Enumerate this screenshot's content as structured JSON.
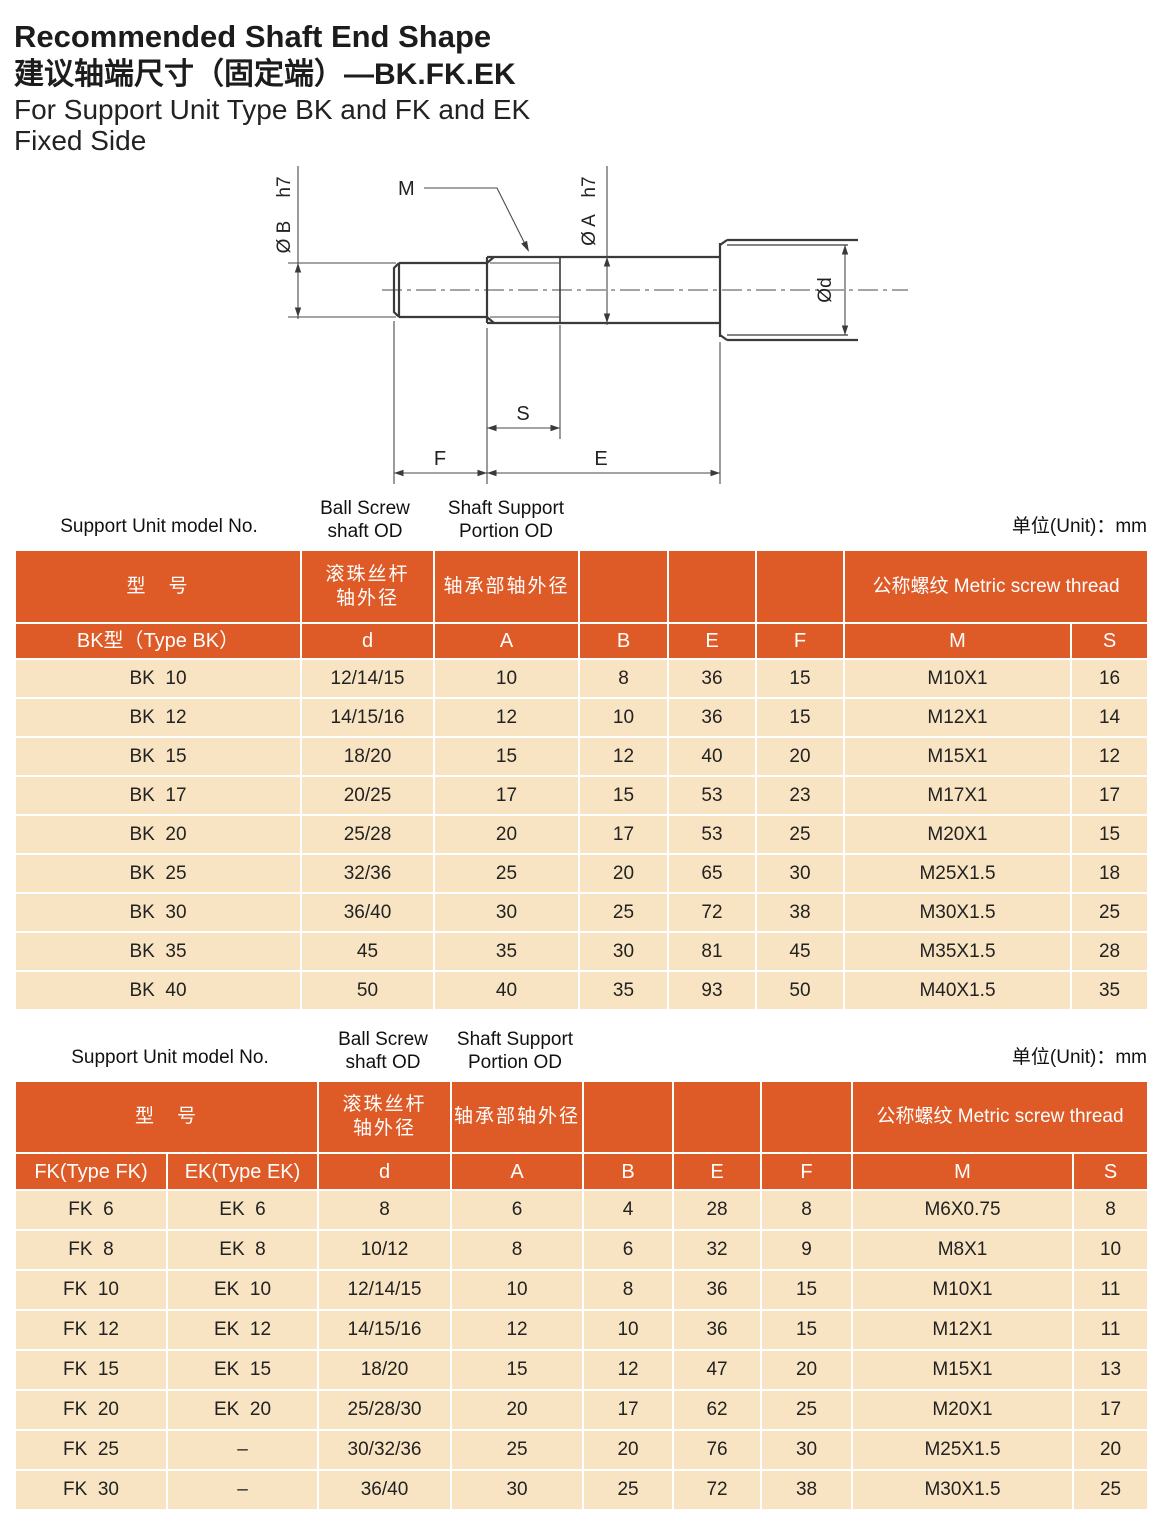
{
  "page": {
    "title_en": "Recommended Shaft End Shape",
    "title_cn": "建议轴端尺寸（固定端）—BK.FK.EK",
    "subtitle_1": "For Support Unit Type BK and FK and EK",
    "subtitle_2": "Fixed Side"
  },
  "colors": {
    "header_orange": "#de5a26",
    "row_beige": "#f8e4c3",
    "line_gray": "#3a3a3a"
  },
  "drawing": {
    "labels": {
      "m": "M",
      "s": "S",
      "f": "F",
      "e": "E",
      "dia_b": "Ø B",
      "h7_b": "h7",
      "dia_a": "Ø A",
      "h7_a": "h7",
      "dia_d": "Ød"
    }
  },
  "tables": {
    "bk": {
      "caption_model": "Support Unit model No.",
      "caption_ballscrew": "Ball Screw\nshaft OD",
      "caption_support": "Shaft Support\nPortion OD",
      "caption_unit": "单位(Unit)：mm",
      "header_model_cn": "型　号",
      "header_ballscrew_cn": "滚珠丝杆\n轴外径",
      "header_support_cn": "轴承部轴外径",
      "header_thread": "公称螺纹 Metric screw thread",
      "subheader": {
        "type": "BK型（Type BK）",
        "d": "d",
        "A": "A",
        "B": "B",
        "E": "E",
        "F": "F",
        "M": "M",
        "S": "S"
      },
      "rows": [
        {
          "model": "BK  10",
          "d": "12/14/15",
          "A": "10",
          "B": "8",
          "E": "36",
          "F": "15",
          "M": "M10X1",
          "S": "16"
        },
        {
          "model": "BK  12",
          "d": "14/15/16",
          "A": "12",
          "B": "10",
          "E": "36",
          "F": "15",
          "M": "M12X1",
          "S": "14"
        },
        {
          "model": "BK  15",
          "d": "18/20",
          "A": "15",
          "B": "12",
          "E": "40",
          "F": "20",
          "M": "M15X1",
          "S": "12"
        },
        {
          "model": "BK  17",
          "d": "20/25",
          "A": "17",
          "B": "15",
          "E": "53",
          "F": "23",
          "M": "M17X1",
          "S": "17"
        },
        {
          "model": "BK  20",
          "d": "25/28",
          "A": "20",
          "B": "17",
          "E": "53",
          "F": "25",
          "M": "M20X1",
          "S": "15"
        },
        {
          "model": "BK  25",
          "d": "32/36",
          "A": "25",
          "B": "20",
          "E": "65",
          "F": "30",
          "M": "M25X1.5",
          "S": "18"
        },
        {
          "model": "BK  30",
          "d": "36/40",
          "A": "30",
          "B": "25",
          "E": "72",
          "F": "38",
          "M": "M30X1.5",
          "S": "25"
        },
        {
          "model": "BK  35",
          "d": "45",
          "A": "35",
          "B": "30",
          "E": "81",
          "F": "45",
          "M": "M35X1.5",
          "S": "28"
        },
        {
          "model": "BK  40",
          "d": "50",
          "A": "40",
          "B": "35",
          "E": "93",
          "F": "50",
          "M": "M40X1.5",
          "S": "35"
        }
      ]
    },
    "fkek": {
      "caption_model": "Support Unit model No.",
      "caption_ballscrew": "Ball Screw\nshaft OD",
      "caption_support": "Shaft Support\nPortion OD",
      "caption_unit": "单位(Unit)：mm",
      "header_model_cn": "型　号",
      "header_ballscrew_cn": "滚珠丝杆\n轴外径",
      "header_support_cn": "轴承部轴外径",
      "header_thread": "公称螺纹 Metric screw thread",
      "subheader": {
        "fk": "FK(Type FK)",
        "ek": "EK(Type EK)",
        "d": "d",
        "A": "A",
        "B": "B",
        "E": "E",
        "F": "F",
        "M": "M",
        "S": "S"
      },
      "rows": [
        {
          "fk": "FK  6",
          "ek": "EK  6",
          "d": "8",
          "A": "6",
          "B": "4",
          "E": "28",
          "F": "8",
          "M": "M6X0.75",
          "S": "8"
        },
        {
          "fk": "FK  8",
          "ek": "EK  8",
          "d": "10/12",
          "A": "8",
          "B": "6",
          "E": "32",
          "F": "9",
          "M": "M8X1",
          "S": "10"
        },
        {
          "fk": "FK  10",
          "ek": "EK  10",
          "d": "12/14/15",
          "A": "10",
          "B": "8",
          "E": "36",
          "F": "15",
          "M": "M10X1",
          "S": "11"
        },
        {
          "fk": "FK  12",
          "ek": "EK  12",
          "d": "14/15/16",
          "A": "12",
          "B": "10",
          "E": "36",
          "F": "15",
          "M": "M12X1",
          "S": "11"
        },
        {
          "fk": "FK  15",
          "ek": "EK  15",
          "d": "18/20",
          "A": "15",
          "B": "12",
          "E": "47",
          "F": "20",
          "M": "M15X1",
          "S": "13"
        },
        {
          "fk": "FK  20",
          "ek": "EK  20",
          "d": "25/28/30",
          "A": "20",
          "B": "17",
          "E": "62",
          "F": "25",
          "M": "M20X1",
          "S": "17"
        },
        {
          "fk": "FK  25",
          "ek": "–",
          "d": "30/32/36",
          "A": "25",
          "B": "20",
          "E": "76",
          "F": "30",
          "M": "M25X1.5",
          "S": "20"
        },
        {
          "fk": "FK  30",
          "ek": "–",
          "d": "36/40",
          "A": "30",
          "B": "25",
          "E": "72",
          "F": "38",
          "M": "M30X1.5",
          "S": "25"
        }
      ]
    }
  }
}
